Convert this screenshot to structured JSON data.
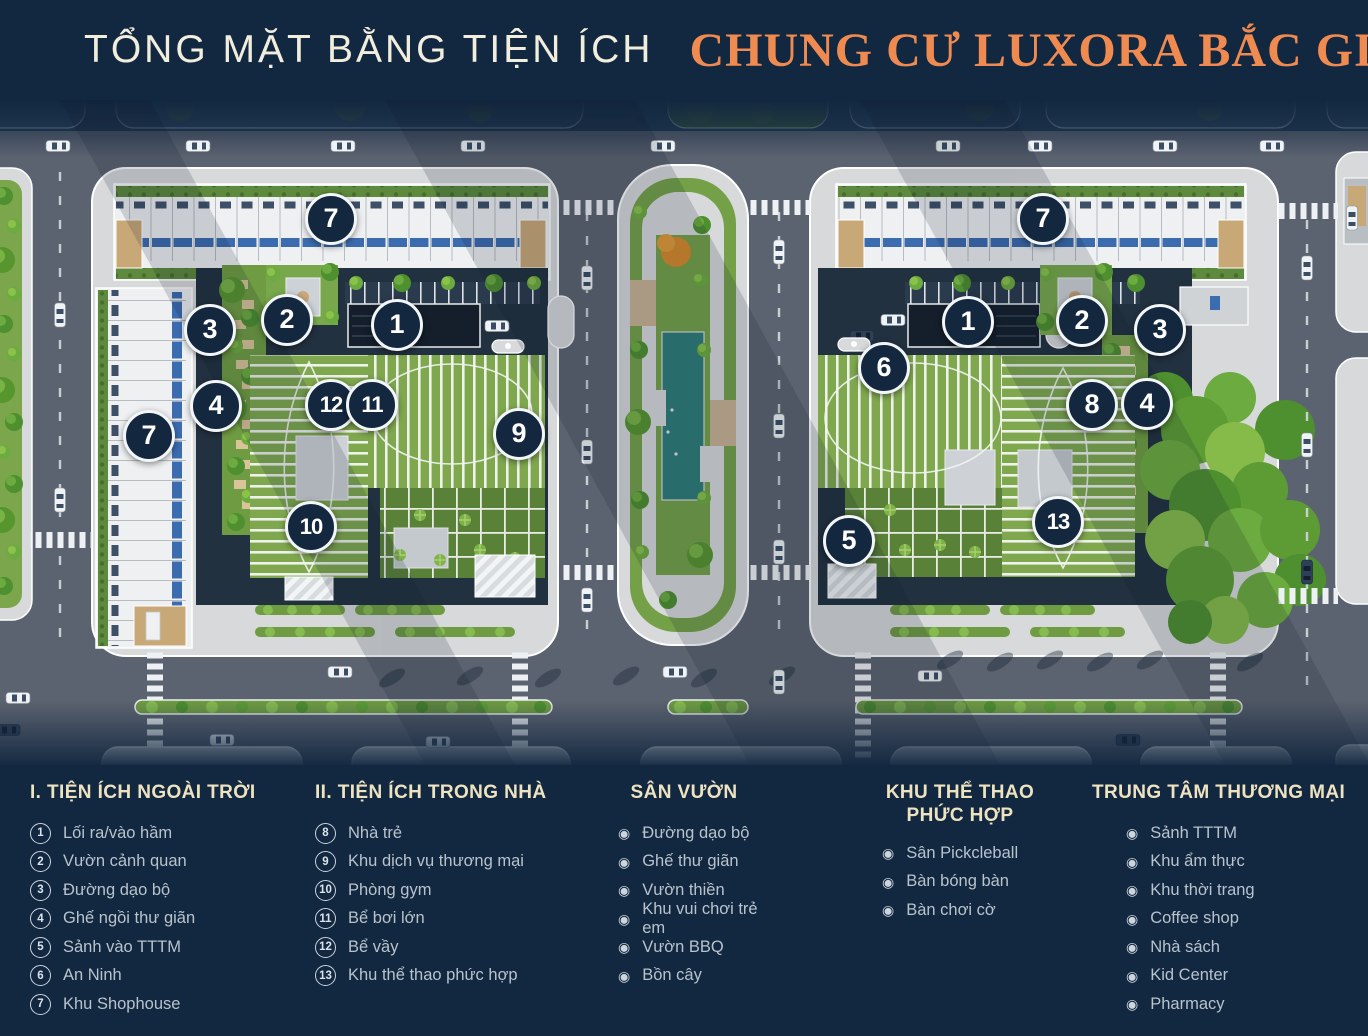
{
  "header": {
    "title_left": "TỔNG MẶT BẰNG TIỆN ÍCH",
    "title_right": "CHUNG CƯ LUXORA BẮC GIANG",
    "accent_color": "#ef8a50"
  },
  "map": {
    "marker_color": "#13273f",
    "markers": [
      {
        "n": "7",
        "x": 331,
        "y": 119
      },
      {
        "n": "2",
        "x": 287,
        "y": 220
      },
      {
        "n": "3",
        "x": 210,
        "y": 230
      },
      {
        "n": "1",
        "x": 397,
        "y": 225
      },
      {
        "n": "4",
        "x": 216,
        "y": 306
      },
      {
        "n": "7",
        "x": 149,
        "y": 336
      },
      {
        "n": "12",
        "x": 331,
        "y": 305
      },
      {
        "n": "11",
        "x": 372,
        "y": 305
      },
      {
        "n": "9",
        "x": 519,
        "y": 334
      },
      {
        "n": "10",
        "x": 311,
        "y": 427
      },
      {
        "n": "7",
        "x": 1043,
        "y": 119
      },
      {
        "n": "1",
        "x": 968,
        "y": 222
      },
      {
        "n": "2",
        "x": 1082,
        "y": 221
      },
      {
        "n": "3",
        "x": 1160,
        "y": 230
      },
      {
        "n": "6",
        "x": 884,
        "y": 268
      },
      {
        "n": "8",
        "x": 1092,
        "y": 305
      },
      {
        "n": "4",
        "x": 1147,
        "y": 304
      },
      {
        "n": "5",
        "x": 849,
        "y": 441
      },
      {
        "n": "13",
        "x": 1058,
        "y": 422
      }
    ]
  },
  "legend": {
    "columns": [
      {
        "title": "I. TIỆN ÍCH NGOÀI TRỜI",
        "type": "numbered",
        "items": [
          {
            "n": "1",
            "label": "Lối ra/vào hầm"
          },
          {
            "n": "2",
            "label": "Vườn cảnh quan"
          },
          {
            "n": "3",
            "label": "Đường dạo bộ"
          },
          {
            "n": "4",
            "label": "Ghế ngồi thư giãn"
          },
          {
            "n": "5",
            "label": "Sảnh vào TTTM"
          },
          {
            "n": "6",
            "label": "An Ninh"
          },
          {
            "n": "7",
            "label": "Khu Shophouse"
          }
        ]
      },
      {
        "title": "II. TIỆN ÍCH TRONG NHÀ",
        "type": "numbered",
        "items": [
          {
            "n": "8",
            "label": "Nhà trẻ"
          },
          {
            "n": "9",
            "label": "Khu dịch vụ thương mại"
          },
          {
            "n": "10",
            "label": "Phòng gym"
          },
          {
            "n": "11",
            "label": "Bể bơi lớn"
          },
          {
            "n": "12",
            "label": "Bể vầy"
          },
          {
            "n": "13",
            "label": "Khu thể thao phức hợp"
          }
        ]
      },
      {
        "title": "SÂN VƯỜN",
        "type": "bullet",
        "items": [
          {
            "label": "Đường dạo bộ"
          },
          {
            "label": "Ghế thư giãn"
          },
          {
            "label": "Vườn thiền"
          },
          {
            "label": "Khu vui chơi trẻ em"
          },
          {
            "label": "Vườn BBQ"
          },
          {
            "label": "Bồn cây"
          }
        ]
      },
      {
        "title": "KHU THỂ THAO",
        "title2": "PHỨC HỢP",
        "type": "bullet",
        "items": [
          {
            "label": "Sân Pickcleball"
          },
          {
            "label": "Bàn bóng bàn"
          },
          {
            "label": "Bàn chơi cờ"
          }
        ]
      },
      {
        "title": "TRUNG TÂM THƯƠNG MẠI",
        "type": "bullet",
        "items": [
          {
            "label": "Sảnh TTTM"
          },
          {
            "label": "Khu ẩm thực"
          },
          {
            "label": "Khu thời trang"
          },
          {
            "label": "Coffee shop"
          },
          {
            "label": "Nhà sách"
          },
          {
            "label": "Kid Center"
          },
          {
            "label": "Pharmacy"
          }
        ]
      }
    ],
    "bullet_glyph": "◉"
  }
}
